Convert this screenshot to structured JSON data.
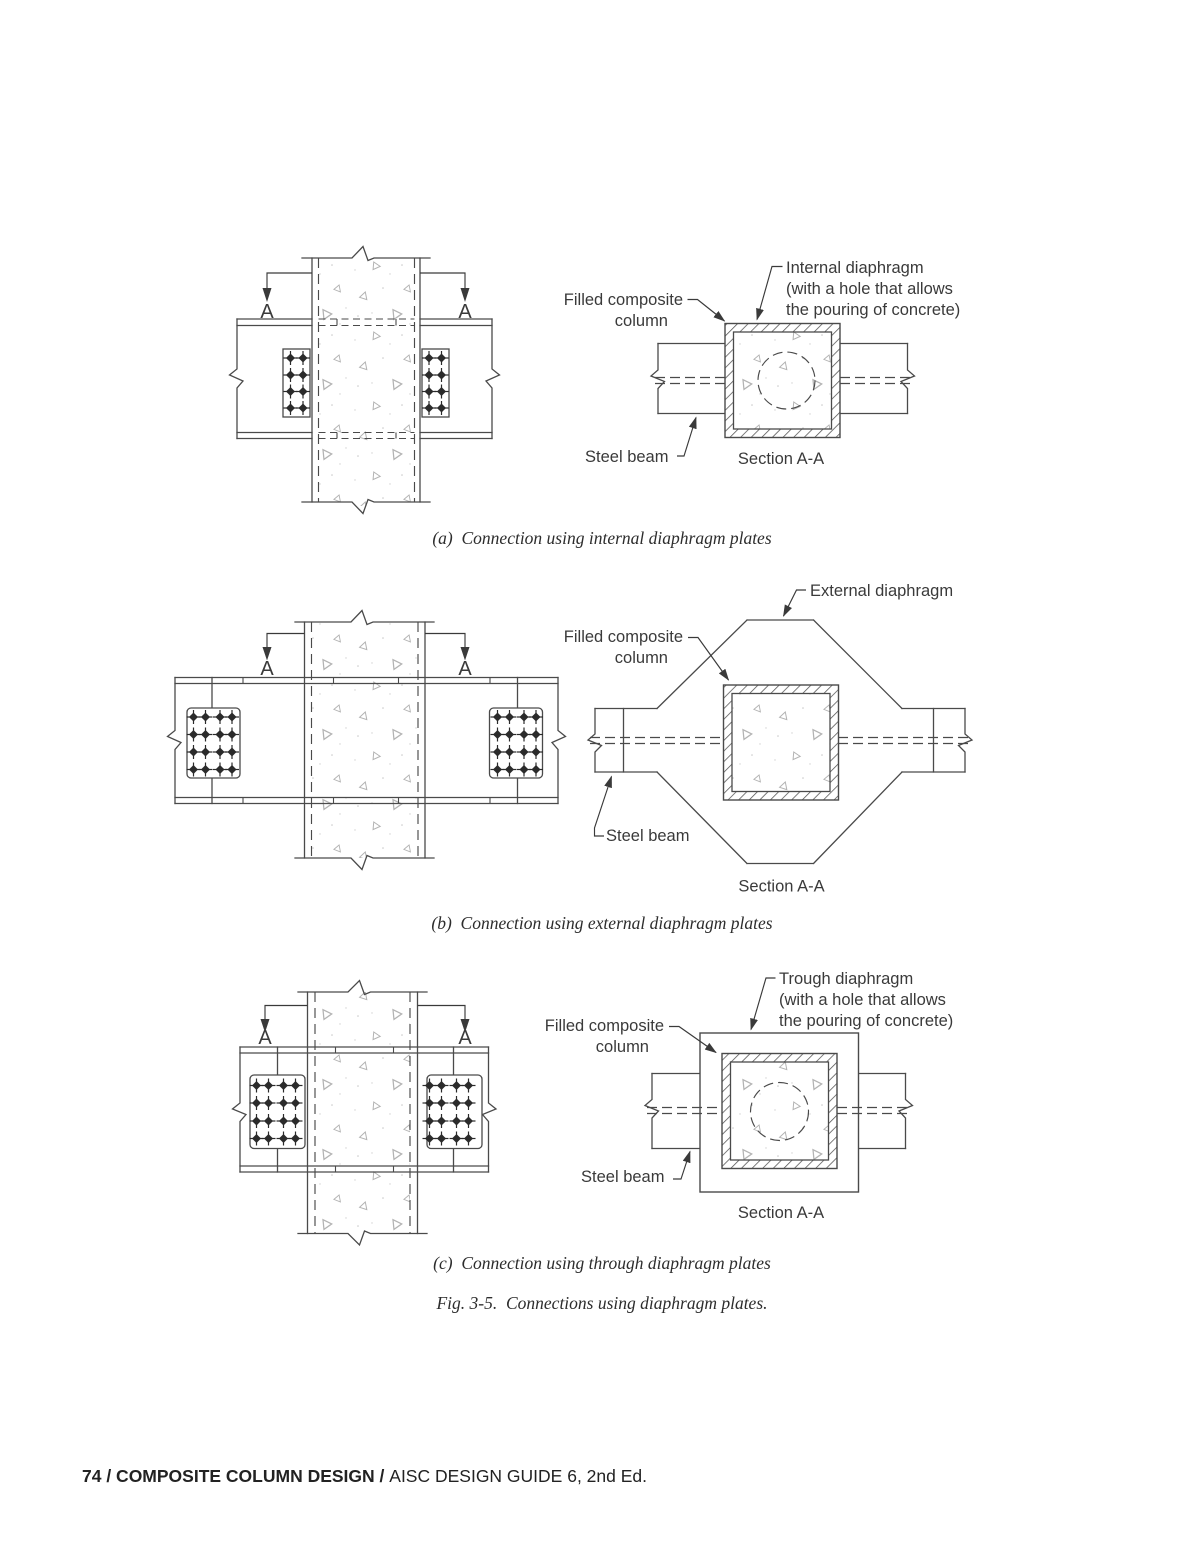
{
  "page": {
    "captions": {
      "a": "(a)  Connection using internal diaphragm plates",
      "b": "(b)  Connection using external diaphragm plates",
      "c": "(c)  Connection using through diaphragm plates",
      "figure": "Fig. 3-5.  Connections using diaphragm plates."
    },
    "footer": {
      "bold": "74 / COMPOSITE COLUMN DESIGN / ",
      "regular": "AISC DESIGN GUIDE 6, 2nd Ed."
    },
    "colors": {
      "line": "#4a4a4a",
      "text": "#3a3a3a",
      "concrete_stipple": "#b3b3b3"
    }
  },
  "figures": {
    "a": {
      "section_marker": "A",
      "section_title": "Section A-A",
      "labels": {
        "diaphragm_line1": "Internal diaphragm",
        "diaphragm_line2": "(with a hole that allows",
        "diaphragm_line3": "the pouring of concrete)",
        "column_line1": "Filled composite",
        "column_line2": "column",
        "beam": "Steel beam"
      }
    },
    "b": {
      "section_marker": "A",
      "section_title": "Section A-A",
      "labels": {
        "diaphragm_line1": "External diaphragm",
        "column_line1": "Filled composite",
        "column_line2": "column",
        "beam": "Steel beam"
      }
    },
    "c": {
      "section_marker": "A",
      "section_title": "Section A-A",
      "labels": {
        "diaphragm_line1": "Trough diaphragm",
        "diaphragm_line2": "(with a hole that allows",
        "diaphragm_line3": "the pouring of concrete)",
        "column_line1": "Filled composite",
        "column_line2": "column",
        "beam": "Steel beam"
      }
    }
  }
}
